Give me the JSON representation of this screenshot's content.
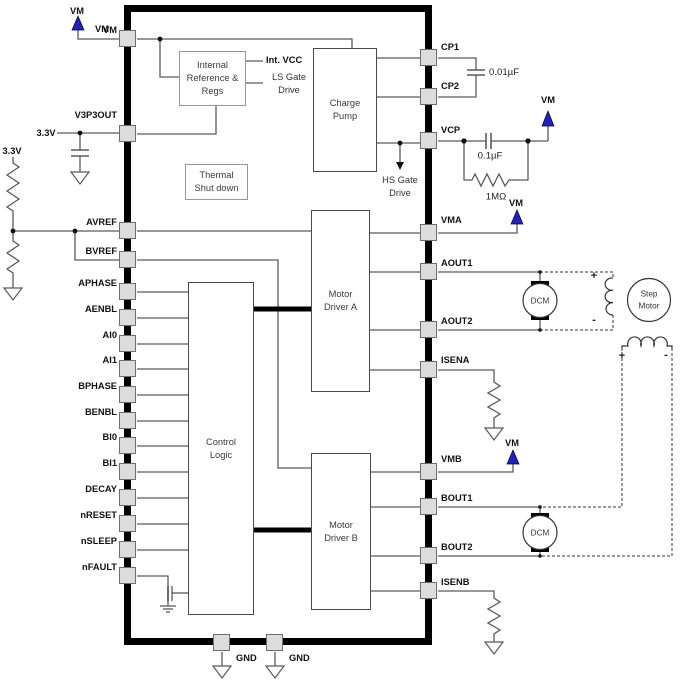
{
  "colors": {
    "arrow_blue": "#2222bb",
    "pin_fill": "#dcdcdc",
    "ic_border": "#000000",
    "wire": "#5a5a5a"
  },
  "ic": {
    "left_pins": [
      "VM",
      "V3P3OUT",
      "AVREF",
      "BVREF",
      "APHASE",
      "AENBL",
      "AI0",
      "AI1",
      "BPHASE",
      "BENBL",
      "BI0",
      "BI1",
      "DECAY",
      "nRESET",
      "nSLEEP",
      "nFAULT"
    ],
    "right_pins": [
      "CP1",
      "CP2",
      "VCP",
      "VMA",
      "AOUT1",
      "AOUT2",
      "ISENA",
      "VMB",
      "BOUT1",
      "BOUT2",
      "ISENB"
    ],
    "bottom_pins": [
      "GND",
      "GND"
    ]
  },
  "blocks": {
    "internal_ref": [
      "Internal",
      "Reference &",
      "Regs"
    ],
    "thermal": [
      "Thermal",
      "Shut down"
    ],
    "charge_pump": [
      "Charge",
      "Pump"
    ],
    "control_logic": [
      "Control",
      "Logic"
    ],
    "motor_driver_a": [
      "Motor",
      "Driver A"
    ],
    "motor_driver_b": [
      "Motor",
      "Driver B"
    ]
  },
  "nets": {
    "vm_top": "VM",
    "vm_at_pin": "VM",
    "vm_vcp": "VM",
    "vm_vma": "VM",
    "vm_vmb": "VM",
    "v33_divider": "3.3V",
    "v33_pin": "3.3V",
    "int_vcc": "Int. VCC",
    "ls_gate": [
      "LS Gate",
      "Drive"
    ],
    "hs_gate": [
      "HS Gate",
      "Drive"
    ],
    "gnd_left": "GND",
    "gnd_right": "GND"
  },
  "components": {
    "cp_cap": "0.01µF",
    "vcp_cap": "0.1µF",
    "vcp_res": "1MΩ",
    "dcm_a": "DCM",
    "dcm_b": "DCM",
    "step_motor": [
      "Step",
      "Motor"
    ],
    "winding_a_plus": "+",
    "winding_a_minus": "-",
    "winding_b_plus": "+",
    "winding_b_minus": "-"
  }
}
